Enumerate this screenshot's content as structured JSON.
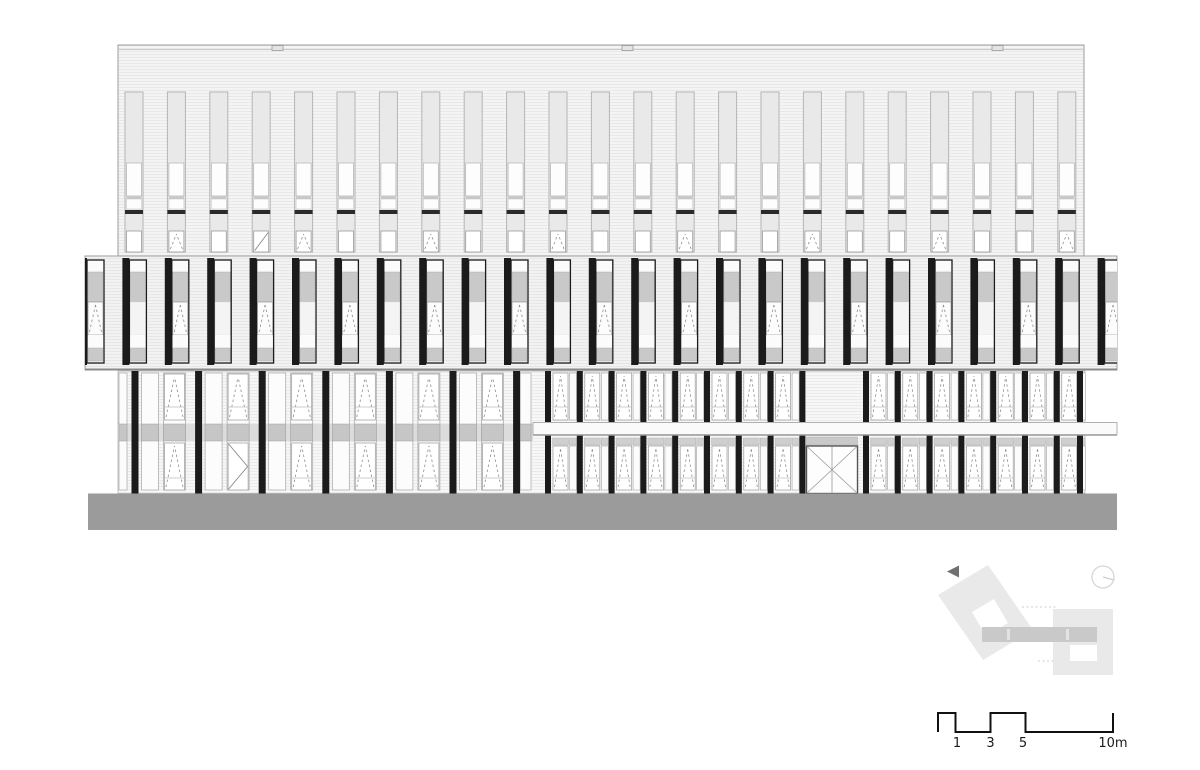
{
  "sheet": {
    "kind": "architectural-elevation-drawing",
    "background": "#ffffff",
    "width": 1200,
    "height": 770
  },
  "colors": {
    "facade_upper": "#f4f4f4",
    "facade_band": "#f2f2f2",
    "facade_lower": "#f7f7f7",
    "outline": "#9e9e9e",
    "light_frame": "#b5b5b5",
    "win_light": "#e9e9e9",
    "win_white": "#fdfdfd",
    "panel_gray": "#c9c9c9",
    "band_gray": "#c6c6c6",
    "left_band_bg": "#dcdcdc",
    "black": "#1b1b1b",
    "floor_bar": "#2a2a2a",
    "frame": "#999999",
    "sash": "#8f8f8f",
    "ground": "#9b9b9b",
    "canopy": "#fafafa",
    "canopy_stroke": "#b0b0b0",
    "transom": "#cfcfcf",
    "door_stroke": "#555555",
    "site_fill": "#e9e9e9",
    "site_bar": "#c9c9c9",
    "site_tick": "#e3e3e3",
    "site_dotted": "#cccccc",
    "compass_stroke": "#d6d6d6",
    "arrow_fill": "#707070",
    "scale_stroke": "#111111",
    "label_color": "#1a1a1a",
    "stripe": "rgba(0,0,0,0.05)"
  },
  "upper_block": {
    "x": 118,
    "y": 45,
    "w": 966,
    "h": 213,
    "parapet_y": 49.5,
    "roof_boxes": {
      "xs": [
        272,
        622,
        992
      ],
      "y": 45.5,
      "w": 11,
      "h": 5
    },
    "windows": {
      "count": 23,
      "x0": 125,
      "pitch": 42.4,
      "w": 18,
      "top": 92,
      "light_end": 162,
      "white_end": 196,
      "div_end": 199,
      "white2_end": 209,
      "bar_y": 210,
      "bar_end": 214,
      "light2_end": 231,
      "bottom": 252,
      "sash_mod": 3,
      "sash_rem": 1,
      "diagonal_index": 3
    }
  },
  "band": {
    "x": 85,
    "y": 256,
    "w": 1032,
    "h": 114,
    "units": {
      "count": 25,
      "x0": 80,
      "pitch": 42.4,
      "w": 24,
      "strip_w": 7,
      "top": 258,
      "panel_top": 260,
      "panel_bottom": 363,
      "white1_end": 272,
      "gray_end": 302,
      "win_end": 335,
      "white2_end": 348,
      "sill_end": 361
    }
  },
  "lower_level": {
    "x": 118,
    "y": 371,
    "w": 967,
    "bottom": 493.5,
    "left_zone": {
      "strip_x0": 131.5,
      "pitch": 63.6,
      "count": 6,
      "strip_w": 7,
      "colA_off": 10,
      "colA_w": 17,
      "colB_off": 32,
      "colB_w": 22,
      "closing_strip_x": 513.1,
      "closing_colA_x": 520,
      "closing_colA_w": 11,
      "edge_col_x": 119,
      "edge_col_w": 8,
      "band_y": 424,
      "band_h": 17,
      "band_x_end": 533,
      "door_bay": 1
    },
    "right_zone": {
      "strip_x0": 545,
      "pitch": 31.8,
      "count": 17,
      "strip_w": 6,
      "win_off": 8,
      "win_w": 15,
      "colB_off": 24.5,
      "colB_w": 7,
      "skip_strip": [
        9
      ],
      "skip_windows": [
        8,
        9
      ],
      "transom_y": 438,
      "transom_h": 7,
      "end_strip_x": 1077
    },
    "windows": {
      "top_y": 373,
      "top_b": 420,
      "top_sill": 407,
      "low_y": 443,
      "low_b": 490,
      "low_y_r": 446,
      "low_sill": 478
    },
    "canopy": {
      "x": 533,
      "y": 422.5,
      "w": 584,
      "h": 12
    },
    "door": {
      "x": 806.5,
      "y": 446,
      "w": 51,
      "h": 47.5,
      "transom_y": 437,
      "transom_h": 8
    }
  },
  "ground": {
    "x": 88,
    "y": 493.5,
    "w": 1029,
    "h": 36.5
  },
  "site_key": {
    "arrow_icon": "view-direction-arrow-icon",
    "compass_icon": "north-indicator-icon",
    "arrow_points": "959,565.5 959,577.5 947,571.5",
    "left_block_outer": "988,565 938,595 983,660 1033,630",
    "left_block_hole": "994,599 972,612 986,636 1008,623",
    "right_block": {
      "x": 1053,
      "y": 609,
      "w": 60,
      "h": 66
    },
    "right_block_hole": {
      "x": 1070,
      "y": 645,
      "w": 27,
      "h": 16
    },
    "bar": {
      "x": 982,
      "y": 627,
      "w": 115,
      "h": 15
    },
    "ticks": [
      {
        "x": 1007,
        "y": 629,
        "w": 3,
        "h": 11
      },
      {
        "x": 1066,
        "y": 629,
        "w": 3,
        "h": 11
      }
    ],
    "dotted": [
      [
        1022,
        607,
        1056,
        607
      ],
      [
        1038,
        661,
        1056,
        661
      ]
    ],
    "compass": {
      "cx": 1103,
      "cy": 577,
      "r": 11,
      "needle": [
        1103,
        577,
        1114,
        580
      ]
    }
  },
  "scale_bar": {
    "y_top": 713,
    "y_bot": 732,
    "stroke_w": 2,
    "xs": {
      "x0": 938,
      "x1": 955.5,
      "x3": 990.5,
      "x5": 1025.5,
      "x10": 1113
    },
    "labels": [
      {
        "text": "1",
        "x": 957
      },
      {
        "text": "3",
        "x": 990.5
      },
      {
        "text": "5",
        "x": 1023
      },
      {
        "text": "10m",
        "x": 1113
      }
    ],
    "label_y": 747,
    "font_size": 13
  }
}
